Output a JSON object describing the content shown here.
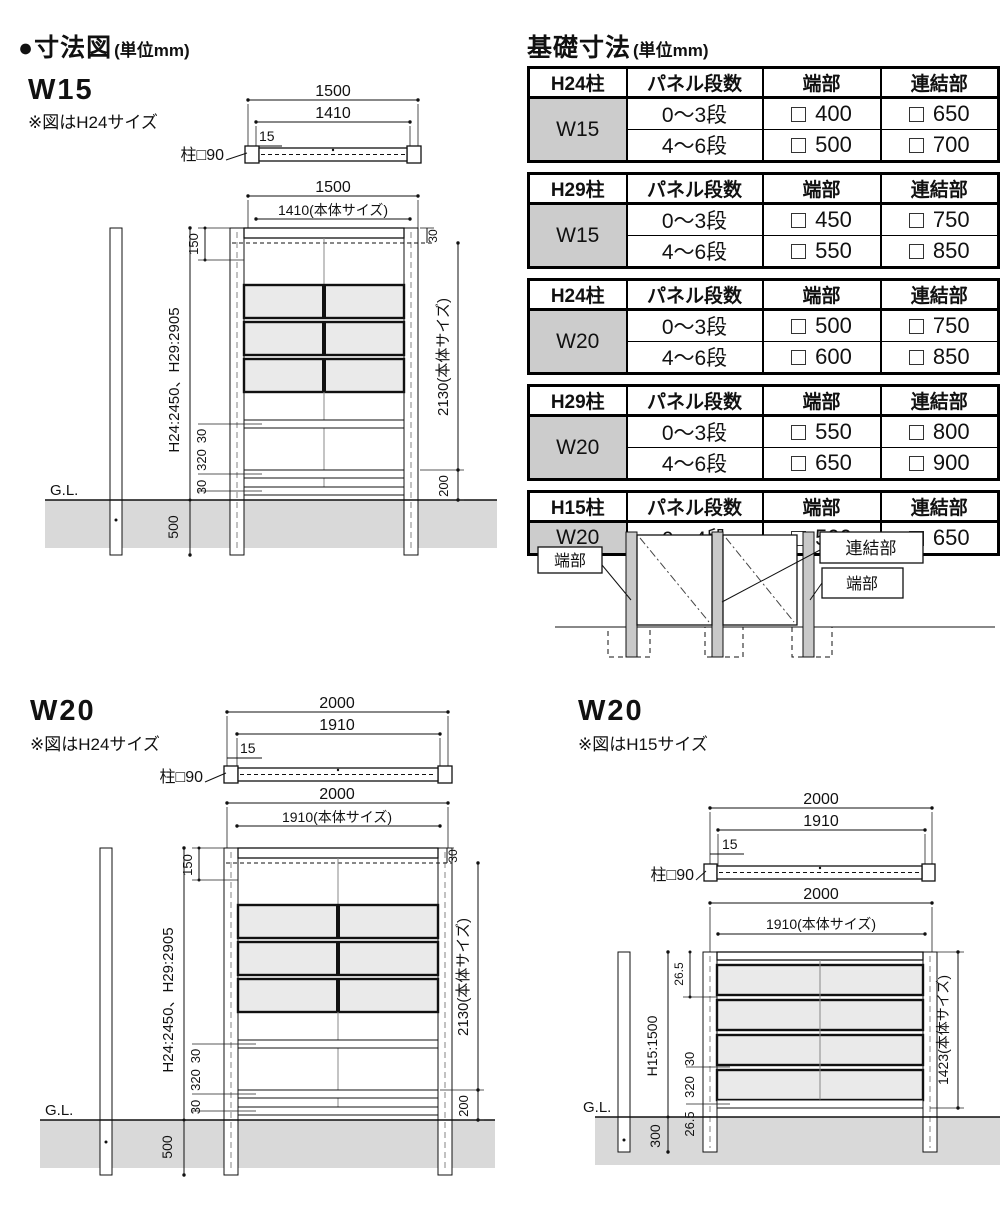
{
  "page": {
    "title": "●寸法図",
    "unit": "(単位mm)"
  },
  "foundation": {
    "title": "基礎寸法",
    "unit": "(単位mm)",
    "headers": {
      "panel": "パネル段数",
      "end": "端部",
      "joint": "連結部"
    },
    "tables": [
      {
        "post": "H24柱",
        "size": "W15",
        "rows": [
          {
            "dan": "0〜3段",
            "end": "400",
            "joint": "650"
          },
          {
            "dan": "4〜6段",
            "end": "500",
            "joint": "700"
          }
        ]
      },
      {
        "post": "H29柱",
        "size": "W15",
        "rows": [
          {
            "dan": "0〜3段",
            "end": "450",
            "joint": "750"
          },
          {
            "dan": "4〜6段",
            "end": "550",
            "joint": "850"
          }
        ]
      },
      {
        "post": "H24柱",
        "size": "W20",
        "rows": [
          {
            "dan": "0〜3段",
            "end": "500",
            "joint": "750"
          },
          {
            "dan": "4〜6段",
            "end": "600",
            "joint": "850"
          }
        ]
      },
      {
        "post": "H29柱",
        "size": "W20",
        "rows": [
          {
            "dan": "0〜3段",
            "end": "550",
            "joint": "800"
          },
          {
            "dan": "4〜6段",
            "end": "650",
            "joint": "900"
          }
        ]
      },
      {
        "post": "H15柱",
        "size": "W20",
        "rows": [
          {
            "dan": "0〜4段",
            "end": "500",
            "joint": "650"
          }
        ]
      }
    ]
  },
  "connection": {
    "end_left": "端部",
    "joint": "連結部",
    "end_right": "端部"
  },
  "w15": {
    "label": "W15",
    "note": "※図はH24サイズ",
    "plan": {
      "overall": "1500",
      "body": "1410",
      "inset": "15",
      "post_label": "柱□90"
    },
    "front": {
      "overall": "1500",
      "body": "1410(本体サイズ)",
      "top": "150",
      "post_h": "H24:2450、H29:2905",
      "r_top": "30",
      "r1": "30",
      "r2": "320",
      "r3": "30",
      "gl": "G.L.",
      "embed": "500",
      "body_h": "2130(本体サイズ)",
      "bottom": "200"
    }
  },
  "w20h24": {
    "label": "W20",
    "note": "※図はH24サイズ",
    "plan": {
      "overall": "2000",
      "body": "1910",
      "inset": "15",
      "post_label": "柱□90"
    },
    "front": {
      "overall": "2000",
      "body": "1910(本体サイズ)",
      "top": "150",
      "post_h": "H24:2450、H29:2905",
      "r_top": "30",
      "r1": "30",
      "r2": "320",
      "r3": "30",
      "gl": "G.L.",
      "embed": "500",
      "body_h": "2130(本体サイズ)",
      "bottom": "200"
    }
  },
  "w20h15": {
    "label": "W20",
    "note": "※図はH15サイズ",
    "plan": {
      "overall": "2000",
      "body": "1910",
      "inset": "15",
      "post_label": "柱□90"
    },
    "front": {
      "overall": "2000",
      "body": "1910(本体サイズ)",
      "top": "26.5",
      "post_h": "H15:1500",
      "r1": "30",
      "r2": "320",
      "r3": "26.5",
      "gl": "G.L.",
      "embed": "300",
      "body_h": "1423(本体サイズ)"
    }
  }
}
